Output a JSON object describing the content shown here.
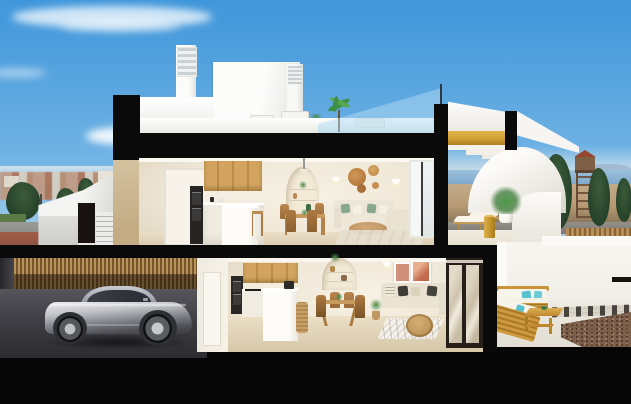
{
  "palette": {
    "sky-top": "#3f96da",
    "sky-mid": "#6fb2e4",
    "sky-low": "#a6cfeb",
    "sky-haze": "#cfe6f4",
    "section-black": "#0a0a0a",
    "wall-cream": "#f7f1e4",
    "wall-white": "#f6f5f1",
    "wood-light": "#d2a45f",
    "wood-dark": "#bb8c4a",
    "floor-beige": "#ecdfc7",
    "floor-beige-dark": "#d5c6a8",
    "slat-wood": "#bb9257",
    "slat-gap": "#73552f",
    "garage-floor": "#55555b",
    "garage-floor-dark": "#2b2b30",
    "car-silver": "#c2c4c9",
    "car-shadow": "#3a3c41",
    "car-glass": "#2c3038",
    "glass-blue": "rgba(170,215,243,0.55)",
    "sea-blue": "#7fa9cd",
    "mountain-haze": "#9db4cc",
    "land-tan": "#b89a74",
    "road-grey": "#93908a",
    "sidewalk-red": "#a05b46",
    "grass-green": "#5c7a48",
    "tree-green": "#26422a",
    "tower-brown": "#7f5f46",
    "tower-roof": "#96462e",
    "gold-wood": "#cf9e34",
    "gold-table": "#c99a30",
    "sofa-cream": "#ece5d6",
    "pillow-green": "#87a88c",
    "pillow-teal": "#58c3ce",
    "outdoor-wood": "#c8943a",
    "gravel-brown": "#7d5f49",
    "art-frame-1": "#cf8f7a",
    "art-frame-2": "#c06a4a",
    "basket-tan": "#b57a3e",
    "exterior-side-wall": "#d9c9a7"
  },
  "scene": {
    "type": "architectural cutaway render of a two-storey townhouse, dollhouse section view",
    "sky": "clear blue sky with wispy white clouds",
    "background_left": "hazy town skyline with terracotta roofs, dark trees, street with red sidewalk",
    "background_right": "sea horizon, distant mountains, watchtower, dark cypress trees, dirt road, wooden fence",
    "roof": [
      "louvered chimney",
      "white stair box",
      "second chimney",
      "roof terrace with white outdoor sofas and table",
      "potted palm",
      "glass stair balustrade"
    ],
    "stairs": "wood-soffit stair flight under white curved canopy between black cut slabs",
    "upper_floor": [
      "white interior door",
      "tall oven column",
      "oak upper cabinets",
      "white base units and island with stool",
      "arched shelf niche",
      "round dining table with four wood chairs",
      "wall baskets and sconces",
      "cream sofa with green pillows",
      "oval wood coffee table",
      "rug",
      "sliding glass door"
    ],
    "upper_terrace": [
      "two wooden sun loungers",
      "gold drum side table",
      "potted palm",
      "curved white parapet"
    ],
    "lower_floor": [
      "oak kitchen with island and coffee machine",
      "rattan stool",
      "arched shelf niche",
      "dining table with four chairs",
      "two art frames",
      "beige corner sofa with cushions",
      "plant in basket",
      "rattan round coffee table",
      "diamond-pattern rug",
      "mirrored sliding wardrobe doors"
    ],
    "lower_terrace": [
      "teak outdoor sofa with white cushions and teal pillows",
      "angled teak lounger",
      "teak coffee table",
      "paver strip",
      "brown gravel bed",
      "white patio walls"
    ],
    "garage": [
      "vertical timber-slat wall",
      "silver sports coupe",
      "dark concrete floor",
      "white side door"
    ],
    "exterior": [
      "white outdoor staircase at left",
      "black section-cut slabs and walls",
      "cream side wall"
    ]
  }
}
